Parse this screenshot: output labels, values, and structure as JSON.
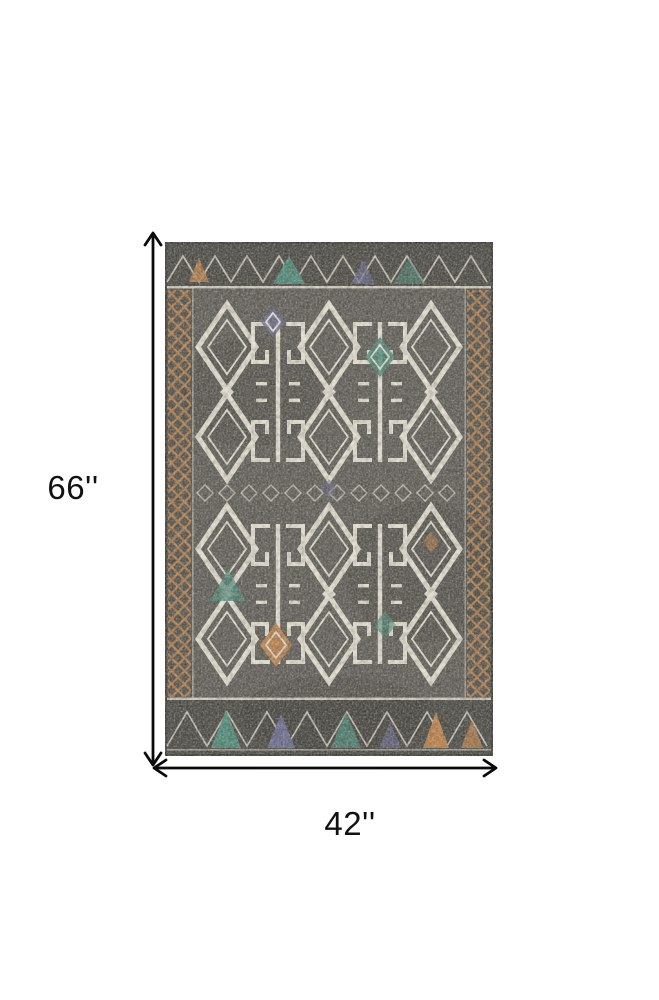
{
  "figure": {
    "height_label": "66''",
    "width_label": "42''"
  },
  "icons": {
    "height_arrow": "vertical-double-headed-arrow",
    "width_arrow": "horizontal-double-headed-arrow"
  },
  "image": {
    "subject": "tribal-pattern-area-rug"
  },
  "colors": {
    "page-bg": "#ffffff",
    "arrow": "#0a0a0a",
    "label": "#111111",
    "rug-edge": "#3c3b37",
    "rug-field": "#615f59",
    "rug-band": "#4b4a45",
    "rug-ivory": "#ebe7da",
    "rug-orange": "#c2854d",
    "rug-teal": "#4f8e7d",
    "rug-purple": "#6e6e95"
  }
}
